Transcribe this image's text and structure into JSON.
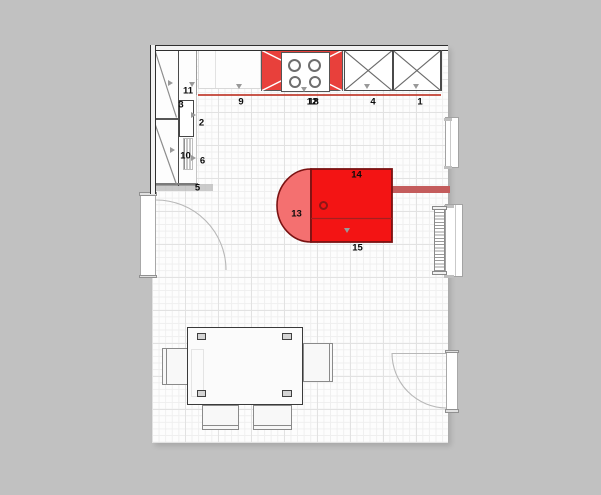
{
  "labels": {
    "n1": "1",
    "n2": "2",
    "n3": "3",
    "n4": "4",
    "n5": "5",
    "n6": "6",
    "n9": "9",
    "n10": "10",
    "n11": "11",
    "n12": "12",
    "n13": "13",
    "n14": "14",
    "n15": "15",
    "n18": "18"
  },
  "colors": {
    "canvas_gray": "#c1c1c1",
    "floor_white": "#fdfdfd",
    "grid_minor": "#efefef",
    "grid_major": "#e2e2e2",
    "wall_dark": "#2f2f2f",
    "hob_red": "#e8403b",
    "island_red": "#f31414",
    "island_red_light": "#f47070",
    "island_border": "#7a1212",
    "accent_red": "#c0392b",
    "bar_red": "#c45c5c",
    "handle_gray": "#999999"
  }
}
